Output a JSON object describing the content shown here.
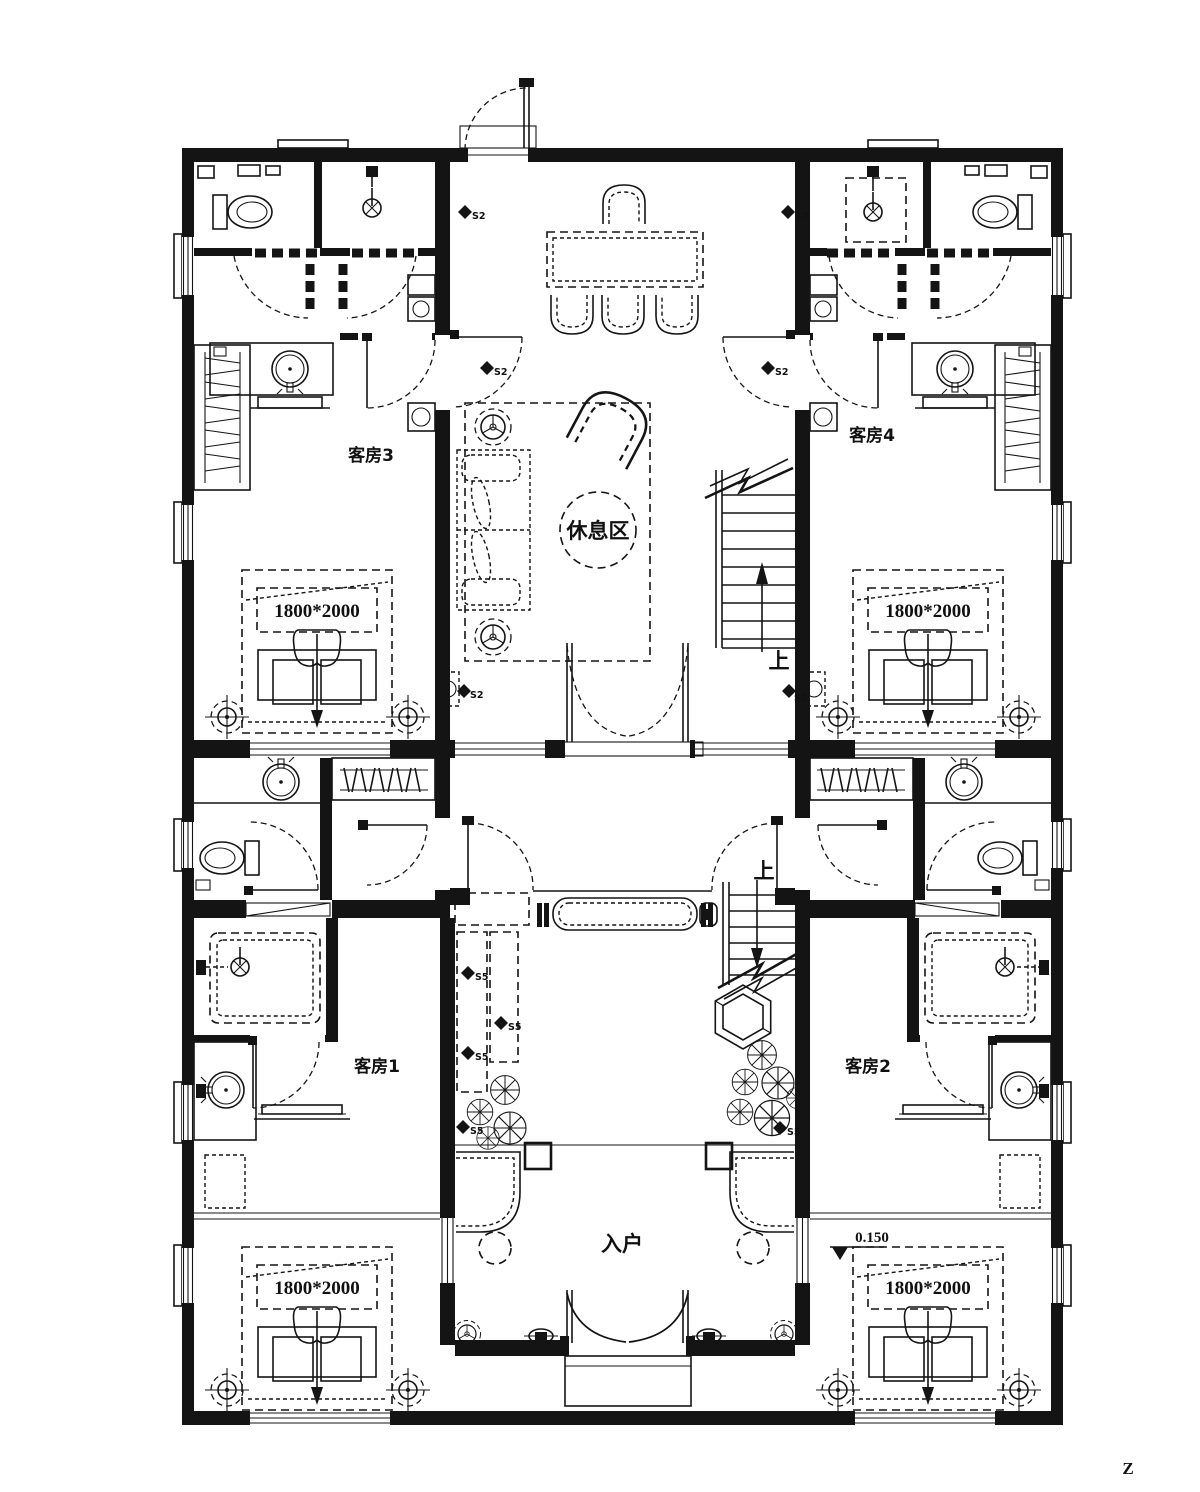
{
  "drawing": {
    "rooms": {
      "guest1": "客房1",
      "guest2": "客房2",
      "guest3": "客房3",
      "guest4": "客房4",
      "lounge": "休息区",
      "entry": "入户"
    },
    "bed_size": "1800*2000",
    "stair_up": "上",
    "elevation": "0.150",
    "switch_s2": "S2",
    "switch_s5": "S5",
    "sheet_mark": "Z"
  }
}
